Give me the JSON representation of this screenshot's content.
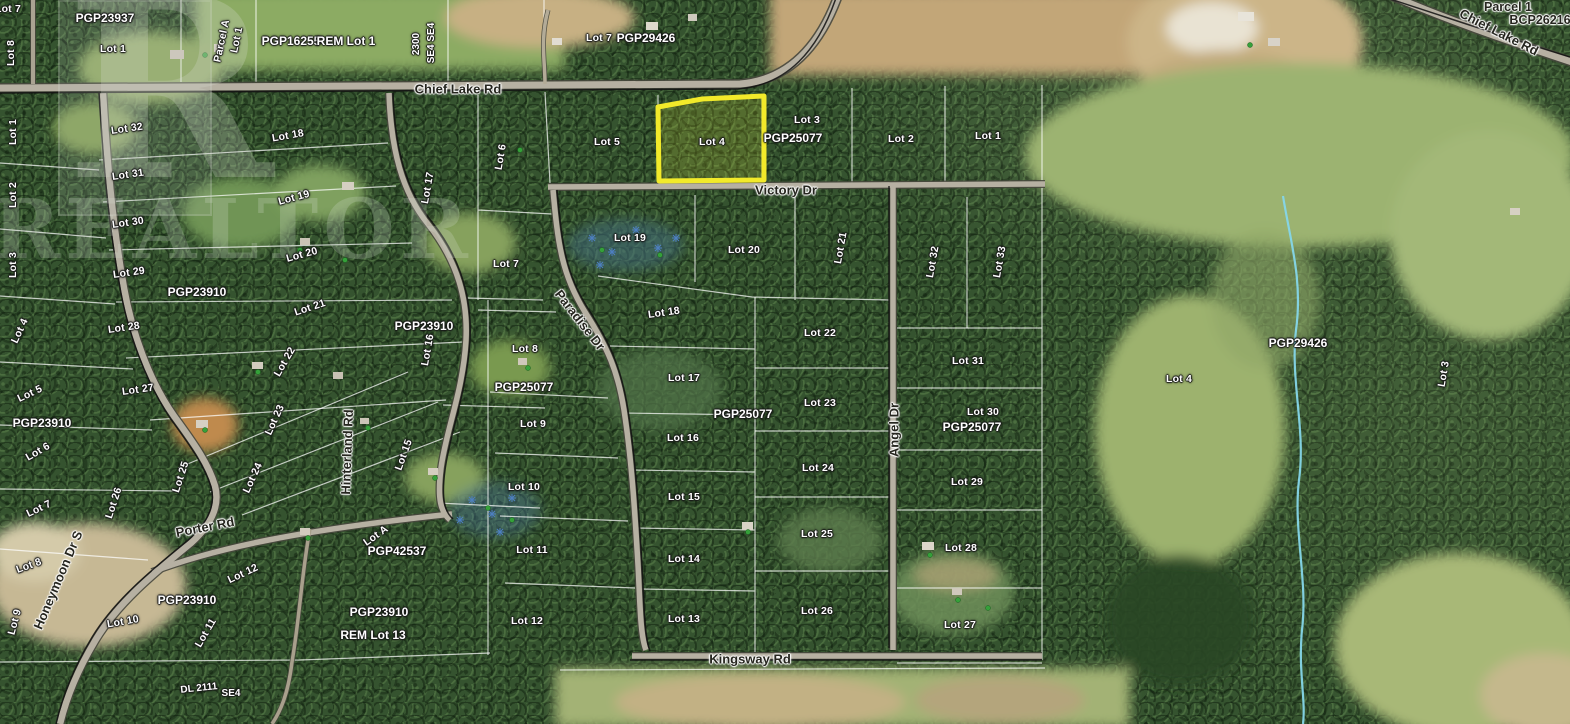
{
  "map": {
    "watermark": {
      "logo_letter": "R",
      "text": "REALTOR"
    },
    "highlight": {
      "label": "Lot 4",
      "color": "#f2ea2a"
    },
    "creek_color": "#85d6e9",
    "labels": [
      {
        "text": "Lot 7",
        "x": 8,
        "y": 9,
        "r": 0,
        "kind": "lot"
      },
      {
        "text": "Lot 8",
        "x": 11,
        "y": 53,
        "r": -90,
        "kind": "lot"
      },
      {
        "text": "PGP23937",
        "x": 105,
        "y": 18,
        "r": 0,
        "kind": "plan"
      },
      {
        "text": "Lot 1",
        "x": 113,
        "y": 49,
        "r": 0,
        "kind": "lot"
      },
      {
        "text": "Parcel A",
        "x": 222,
        "y": 41,
        "r": -78,
        "kind": "lot"
      },
      {
        "text": "Lot 1",
        "x": 237,
        "y": 40,
        "r": -78,
        "kind": "lot"
      },
      {
        "text": "PGP16255",
        "x": 291,
        "y": 41,
        "r": 0,
        "kind": "plan"
      },
      {
        "text": "REM Lot 1",
        "x": 346,
        "y": 41,
        "r": 0,
        "kind": "plan"
      },
      {
        "text": "2300",
        "x": 417,
        "y": 44,
        "r": -90,
        "kind": "sec"
      },
      {
        "text": "SE4 SE4",
        "x": 432,
        "y": 43,
        "r": -90,
        "kind": "sec"
      },
      {
        "text": "Lot 7",
        "x": 599,
        "y": 38,
        "r": 0,
        "kind": "lot"
      },
      {
        "text": "PGP29426",
        "x": 646,
        "y": 38,
        "r": 0,
        "kind": "plan"
      },
      {
        "text": "Parcel 1",
        "x": 1508,
        "y": 7,
        "r": 0,
        "kind": "dark"
      },
      {
        "text": "BCP26216",
        "x": 1540,
        "y": 20,
        "r": 0,
        "kind": "dark"
      },
      {
        "text": "Chief Lake Rd",
        "x": 458,
        "y": 89,
        "r": 0,
        "kind": "road"
      },
      {
        "text": "Chief Lake Rd",
        "x": 1499,
        "y": 32,
        "r": 27,
        "kind": "road"
      },
      {
        "text": "Lot 1",
        "x": 13,
        "y": 132,
        "r": -90,
        "kind": "lot"
      },
      {
        "text": "Lot 2",
        "x": 13,
        "y": 195,
        "r": -90,
        "kind": "lot"
      },
      {
        "text": "Lot 3",
        "x": 13,
        "y": 265,
        "r": -90,
        "kind": "lot"
      },
      {
        "text": "Lot 4",
        "x": 20,
        "y": 331,
        "r": -65,
        "kind": "lot"
      },
      {
        "text": "Lot 5",
        "x": 30,
        "y": 394,
        "r": -25,
        "kind": "lot"
      },
      {
        "text": "PGP23910",
        "x": 42,
        "y": 423,
        "r": 0,
        "kind": "plan"
      },
      {
        "text": "Lot 6",
        "x": 38,
        "y": 452,
        "r": -30,
        "kind": "lot"
      },
      {
        "text": "Lot 7",
        "x": 39,
        "y": 509,
        "r": -25,
        "kind": "lot"
      },
      {
        "text": "Lot 8",
        "x": 29,
        "y": 566,
        "r": -20,
        "kind": "lot"
      },
      {
        "text": "Lot 9",
        "x": 15,
        "y": 622,
        "r": -75,
        "kind": "lot"
      },
      {
        "text": "Lot 10",
        "x": 123,
        "y": 622,
        "r": -10,
        "kind": "lot"
      },
      {
        "text": "Lot 11",
        "x": 206,
        "y": 633,
        "r": -60,
        "kind": "lot"
      },
      {
        "text": "Lot 12",
        "x": 243,
        "y": 574,
        "r": -25,
        "kind": "lot"
      },
      {
        "text": "Lot 32",
        "x": 127,
        "y": 129,
        "r": -8,
        "kind": "lot"
      },
      {
        "text": "Lot 31",
        "x": 128,
        "y": 175,
        "r": -8,
        "kind": "lot"
      },
      {
        "text": "Lot 30",
        "x": 128,
        "y": 223,
        "r": -8,
        "kind": "lot"
      },
      {
        "text": "Lot 29",
        "x": 129,
        "y": 273,
        "r": -8,
        "kind": "lot"
      },
      {
        "text": "PGP23910",
        "x": 197,
        "y": 292,
        "r": 0,
        "kind": "plan"
      },
      {
        "text": "Lot 28",
        "x": 124,
        "y": 328,
        "r": -8,
        "kind": "lot"
      },
      {
        "text": "Lot 27",
        "x": 138,
        "y": 390,
        "r": -8,
        "kind": "lot"
      },
      {
        "text": "Lot 26",
        "x": 114,
        "y": 503,
        "r": -72,
        "kind": "lot"
      },
      {
        "text": "Lot 25",
        "x": 181,
        "y": 477,
        "r": -72,
        "kind": "lot"
      },
      {
        "text": "Lot 24",
        "x": 253,
        "y": 478,
        "r": -65,
        "kind": "lot"
      },
      {
        "text": "Lot 23",
        "x": 275,
        "y": 420,
        "r": -65,
        "kind": "lot"
      },
      {
        "text": "Lot 22",
        "x": 285,
        "y": 362,
        "r": -60,
        "kind": "lot"
      },
      {
        "text": "Lot 21",
        "x": 310,
        "y": 308,
        "r": -18,
        "kind": "lot"
      },
      {
        "text": "Lot 20",
        "x": 302,
        "y": 255,
        "r": -15,
        "kind": "lot"
      },
      {
        "text": "Lot 19",
        "x": 294,
        "y": 198,
        "r": -15,
        "kind": "lot"
      },
      {
        "text": "Lot 18",
        "x": 288,
        "y": 136,
        "r": -10,
        "kind": "lot"
      },
      {
        "text": "Hinterland Rd",
        "x": 347,
        "y": 452,
        "r": -88,
        "kind": "road"
      },
      {
        "text": "Lot 17",
        "x": 428,
        "y": 188,
        "r": -80,
        "kind": "lot"
      },
      {
        "text": "PGP23910",
        "x": 424,
        "y": 326,
        "r": 0,
        "kind": "plan"
      },
      {
        "text": "Lot 16",
        "x": 428,
        "y": 350,
        "r": -80,
        "kind": "lot"
      },
      {
        "text": "Lot 15",
        "x": 404,
        "y": 455,
        "r": -70,
        "kind": "lot"
      },
      {
        "text": "Lot A",
        "x": 376,
        "y": 536,
        "r": -35,
        "kind": "lot"
      },
      {
        "text": "PGP42537",
        "x": 397,
        "y": 551,
        "r": 0,
        "kind": "plan"
      },
      {
        "text": "Porter Rd",
        "x": 205,
        "y": 527,
        "r": -11,
        "kind": "road"
      },
      {
        "text": "Honeymoon Dr S",
        "x": 58,
        "y": 580,
        "r": -67,
        "kind": "road"
      },
      {
        "text": "PGP23910",
        "x": 187,
        "y": 600,
        "r": 0,
        "kind": "plan"
      },
      {
        "text": "PGP23910",
        "x": 379,
        "y": 612,
        "r": 0,
        "kind": "plan"
      },
      {
        "text": "REM Lot 13",
        "x": 373,
        "y": 635,
        "r": 0,
        "kind": "plan"
      },
      {
        "text": "DL 2111",
        "x": 199,
        "y": 689,
        "r": -6,
        "kind": "sec"
      },
      {
        "text": "SE4",
        "x": 231,
        "y": 694,
        "r": 0,
        "kind": "sec"
      },
      {
        "text": "Lot 6",
        "x": 501,
        "y": 157,
        "r": -80,
        "kind": "lot"
      },
      {
        "text": "Lot 7",
        "x": 506,
        "y": 264,
        "r": 0,
        "kind": "lot"
      },
      {
        "text": "Lot 8",
        "x": 525,
        "y": 349,
        "r": 0,
        "kind": "lot"
      },
      {
        "text": "PGP25077",
        "x": 524,
        "y": 387,
        "r": 0,
        "kind": "plan"
      },
      {
        "text": "Lot 9",
        "x": 533,
        "y": 424,
        "r": 0,
        "kind": "lot"
      },
      {
        "text": "Lot 10",
        "x": 524,
        "y": 487,
        "r": 0,
        "kind": "lot"
      },
      {
        "text": "Lot 11",
        "x": 532,
        "y": 550,
        "r": 0,
        "kind": "lot"
      },
      {
        "text": "Lot 12",
        "x": 527,
        "y": 621,
        "r": 0,
        "kind": "lot"
      },
      {
        "text": "Paradise Dr",
        "x": 580,
        "y": 320,
        "r": 52,
        "kind": "road"
      },
      {
        "text": "Lot 5",
        "x": 607,
        "y": 142,
        "r": 0,
        "kind": "lot"
      },
      {
        "text": "Lot 4",
        "x": 712,
        "y": 142,
        "r": 0,
        "kind": "lot"
      },
      {
        "text": "Lot 3",
        "x": 807,
        "y": 120,
        "r": 0,
        "kind": "lot"
      },
      {
        "text": "PGP25077",
        "x": 793,
        "y": 138,
        "r": 0,
        "kind": "plan"
      },
      {
        "text": "Lot 2",
        "x": 901,
        "y": 139,
        "r": 0,
        "kind": "lot"
      },
      {
        "text": "Lot 1",
        "x": 988,
        "y": 136,
        "r": 0,
        "kind": "lot"
      },
      {
        "text": "Victory Dr",
        "x": 786,
        "y": 190,
        "r": 0,
        "kind": "road"
      },
      {
        "text": "Lot 19",
        "x": 630,
        "y": 238,
        "r": 0,
        "kind": "lot"
      },
      {
        "text": "Lot 20",
        "x": 744,
        "y": 250,
        "r": 0,
        "kind": "lot"
      },
      {
        "text": "Lot 21",
        "x": 841,
        "y": 248,
        "r": -80,
        "kind": "lot"
      },
      {
        "text": "Lot 18",
        "x": 664,
        "y": 313,
        "r": -8,
        "kind": "lot"
      },
      {
        "text": "Lot 22",
        "x": 820,
        "y": 333,
        "r": 0,
        "kind": "lot"
      },
      {
        "text": "Lot 17",
        "x": 684,
        "y": 378,
        "r": 0,
        "kind": "lot"
      },
      {
        "text": "PGP25077",
        "x": 743,
        "y": 414,
        "r": 0,
        "kind": "plan"
      },
      {
        "text": "Lot 16",
        "x": 683,
        "y": 438,
        "r": 0,
        "kind": "lot"
      },
      {
        "text": "Lot 23",
        "x": 820,
        "y": 403,
        "r": 0,
        "kind": "lot"
      },
      {
        "text": "Lot 24",
        "x": 818,
        "y": 468,
        "r": 0,
        "kind": "lot"
      },
      {
        "text": "Lot 15",
        "x": 684,
        "y": 497,
        "r": 0,
        "kind": "lot"
      },
      {
        "text": "Lot 25",
        "x": 817,
        "y": 534,
        "r": 0,
        "kind": "lot"
      },
      {
        "text": "Lot 14",
        "x": 684,
        "y": 559,
        "r": 0,
        "kind": "lot"
      },
      {
        "text": "Lot 13",
        "x": 684,
        "y": 619,
        "r": 0,
        "kind": "lot"
      },
      {
        "text": "Lot 26",
        "x": 817,
        "y": 611,
        "r": 0,
        "kind": "lot"
      },
      {
        "text": "Kingsway Rd",
        "x": 750,
        "y": 659,
        "r": 0,
        "kind": "road"
      },
      {
        "text": "Angel Dr",
        "x": 894,
        "y": 430,
        "r": -90,
        "kind": "road"
      },
      {
        "text": "Lot 32",
        "x": 933,
        "y": 262,
        "r": -80,
        "kind": "lot"
      },
      {
        "text": "Lot 33",
        "x": 1000,
        "y": 262,
        "r": -80,
        "kind": "lot"
      },
      {
        "text": "Lot 31",
        "x": 968,
        "y": 361,
        "r": 0,
        "kind": "lot"
      },
      {
        "text": "Lot 30",
        "x": 983,
        "y": 412,
        "r": 0,
        "kind": "lot"
      },
      {
        "text": "PGP25077",
        "x": 972,
        "y": 427,
        "r": 0,
        "kind": "plan"
      },
      {
        "text": "Lot 29",
        "x": 967,
        "y": 482,
        "r": 0,
        "kind": "lot"
      },
      {
        "text": "Lot 28",
        "x": 961,
        "y": 548,
        "r": 0,
        "kind": "lot"
      },
      {
        "text": "Lot 27",
        "x": 960,
        "y": 625,
        "r": 0,
        "kind": "lot"
      },
      {
        "text": "Lot 4",
        "x": 1179,
        "y": 379,
        "r": 0,
        "kind": "lot"
      },
      {
        "text": "PGP29426",
        "x": 1298,
        "y": 343,
        "r": 0,
        "kind": "plan"
      },
      {
        "text": "Lot 3",
        "x": 1444,
        "y": 374,
        "r": -80,
        "kind": "lot"
      }
    ]
  }
}
